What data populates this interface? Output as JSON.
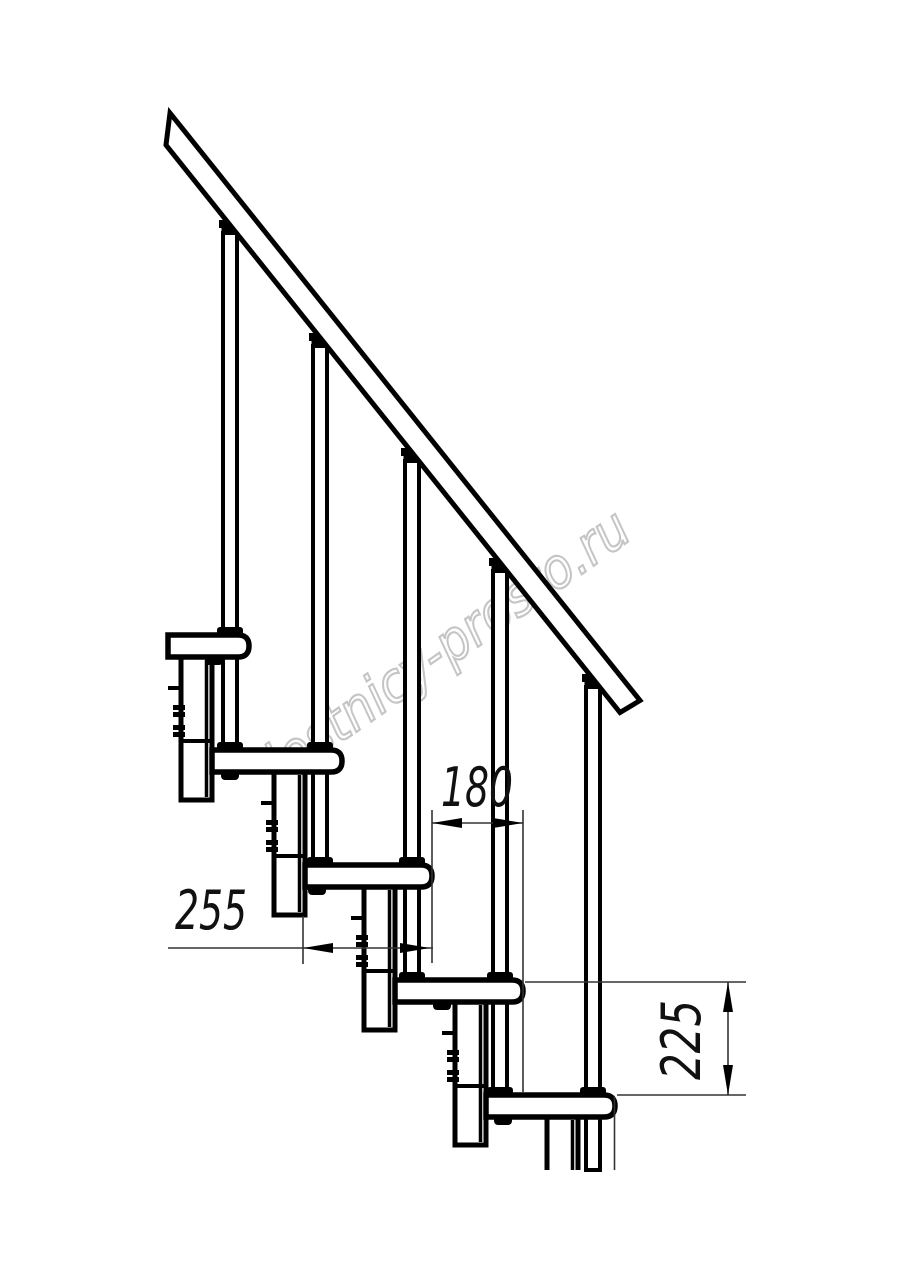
{
  "watermark": {
    "text": "lestnicy-prosto.ru",
    "color": "#c5c5c5"
  },
  "dimensions": {
    "tread_run": "255",
    "step_offset": "180",
    "riser_height": "225"
  },
  "drawing": {
    "type": "staircase-side-elevation",
    "ink_color": "#000000",
    "background_color": "#ffffff",
    "steps_visible": 5
  }
}
